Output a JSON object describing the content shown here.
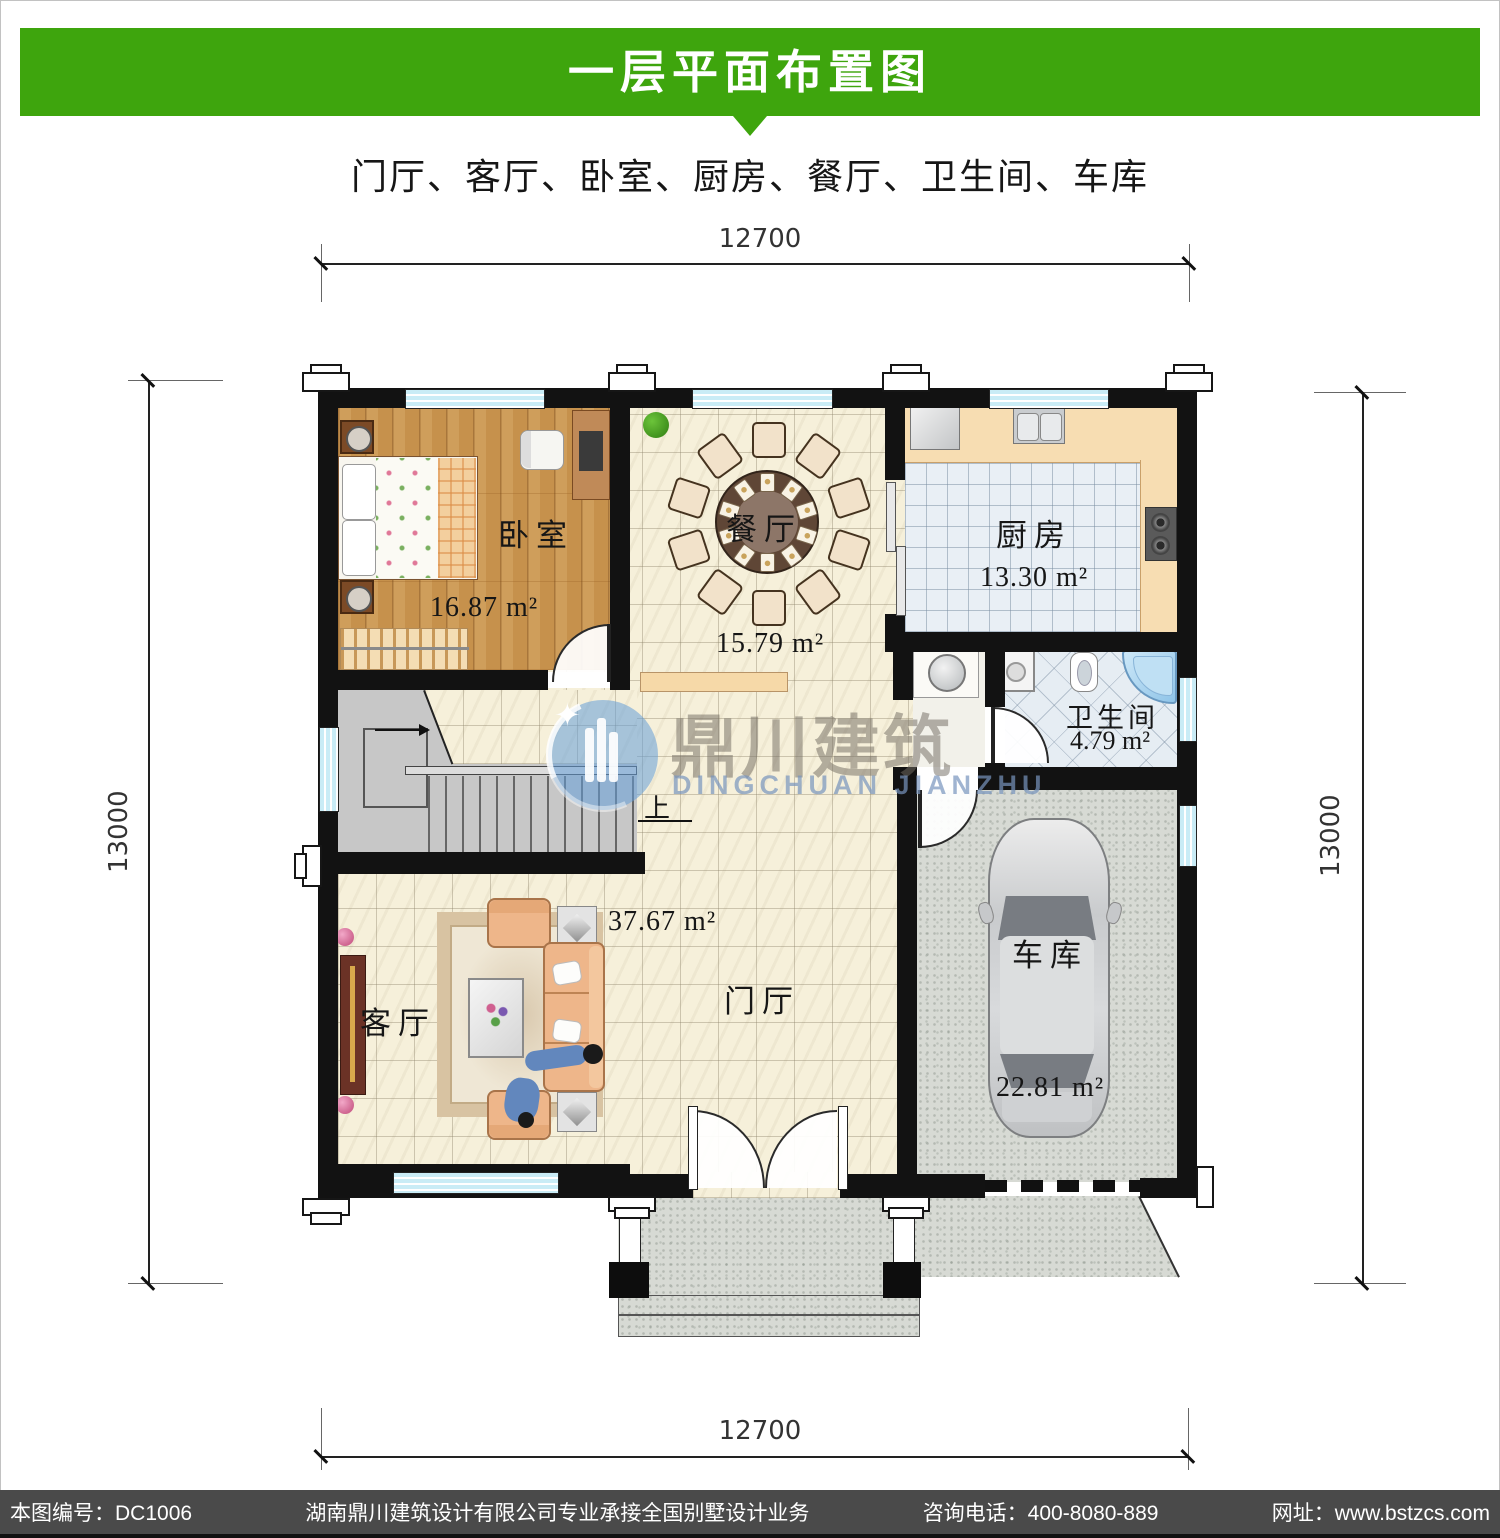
{
  "header": {
    "title": "一层平面布置图",
    "subtitle": "门厅、客厅、卧室、厨房、餐厅、卫生间、车库"
  },
  "dims": {
    "top": "12700",
    "bottom": "12700",
    "left": "13000",
    "right": "13000"
  },
  "rooms": {
    "bedroom": {
      "label": "卧室",
      "area": "16.87 m²"
    },
    "dining": {
      "label": "餐厅",
      "area": "15.79 m²"
    },
    "kitchen": {
      "label": "厨房",
      "area": "13.30 m²"
    },
    "bath": {
      "label": "卫生间",
      "area": "4.79 m²"
    },
    "garage": {
      "label": "车库",
      "area": "22.81 m²"
    },
    "living": {
      "label": "客厅"
    },
    "foyer": {
      "label": "门厅"
    },
    "hall": {
      "area": "37.67 m²"
    }
  },
  "stairs": {
    "up": "上"
  },
  "watermark": {
    "cn": "鼎川建筑",
    "en": "DINGCHUAN JIANZHU"
  },
  "footer": {
    "items": [
      "本图编号：DC1006",
      "湖南鼎川建筑设计有限公司专业承接全国别墅设计业务",
      "咨询电话：400-8080-889",
      "网址：www.bstzcs.com"
    ]
  },
  "colors": {
    "banner_green": "#3ea50d",
    "footer_bg": "#4a4a4a",
    "wall": "#121212",
    "window_cyan": "#c9ecf6",
    "wood_floor": "#c6914c",
    "tile_cream": "#f6f0da",
    "tile_blue": "#e9eff5",
    "concrete": "#d7dad4",
    "counter": "#f7ddb2",
    "sofa": "#eeb68a",
    "bathtub_blue": "#a8d0ec"
  }
}
